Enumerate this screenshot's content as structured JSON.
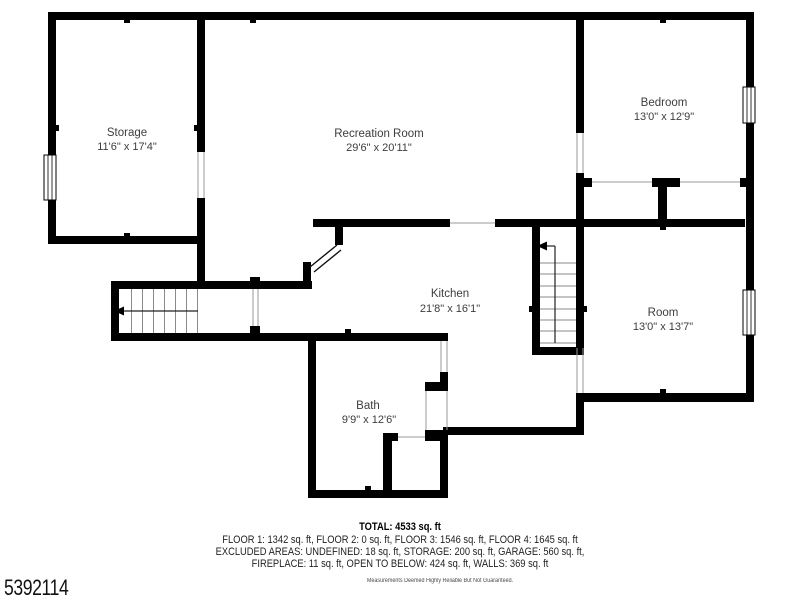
{
  "watermark": "5392114",
  "rooms": [
    {
      "name": "Storage",
      "dims": "11'6\" x 17'4\""
    },
    {
      "name": "Recreation Room",
      "dims": "29'6\" x 20'11\""
    },
    {
      "name": "Bedroom",
      "dims": "13'0\" x 12'9\""
    },
    {
      "name": "Kitchen",
      "dims": "21'8\" x 16'1\""
    },
    {
      "name": "Room",
      "dims": "13'0\" x 13'7\""
    },
    {
      "name": "Bath",
      "dims": "9'9\" x 12'6\""
    }
  ],
  "footer": {
    "total": "TOTAL: 4533 sq. ft",
    "floors": "FLOOR 1: 1342 sq. ft, FLOOR 2: 0 sq. ft, FLOOR 3: 1546 sq. ft, FLOOR 4: 1645 sq. ft",
    "excluded_line1": "EXCLUDED AREAS: UNDEFINED: 18 sq. ft, STORAGE: 200 sq. ft, GARAGE: 560 sq. ft,",
    "excluded_line2": "FIREPLACE: 11 sq. ft, OPEN TO BELOW: 424 sq. ft, WALLS: 369 sq. ft",
    "disclaimer": "Measurements Deemed Highly Reliable But Not Guaranteed."
  },
  "colors": {
    "wall": "#000000",
    "label": "#3d3d3d",
    "door_line": "#9a9a9a",
    "tread_line": "#8a8a8a"
  }
}
